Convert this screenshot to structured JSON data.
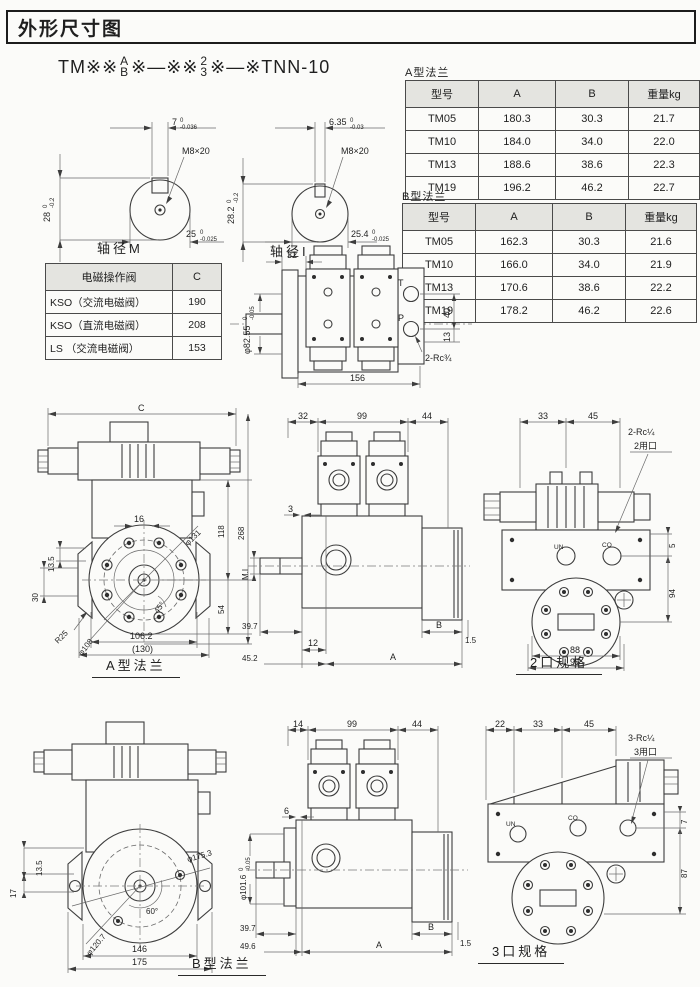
{
  "page": {
    "title": "外形尺寸图"
  },
  "model": {
    "prefix": "TM※※",
    "stack1_top": "A",
    "stack1_bottom": "B",
    "mid": "※—※※",
    "stack2_top": "2",
    "stack2_bottom": "3",
    "suffix": "※—※TNN-10"
  },
  "shaft_m": {
    "caption": "轴径M",
    "thread": "M8×20",
    "width": {
      "val": "7",
      "tol_top": "0",
      "tol_bot": "-0.036"
    },
    "height": {
      "val": "28",
      "tol_top": "0",
      "tol_bot": "-0.2"
    },
    "dia": {
      "val": "25",
      "tol_top": "0",
      "tol_bot": "-0.025"
    }
  },
  "shaft_i": {
    "caption": "轴径I",
    "thread": "M8×20",
    "width": {
      "val": "6.35",
      "tol_top": "0",
      "tol_bot": "-0.03"
    },
    "height": {
      "val": "28.2",
      "tol_top": "0",
      "tol_bot": "-0.2"
    },
    "dia": {
      "val": "25.4",
      "tol_top": "0",
      "tol_bot": "-0.025"
    }
  },
  "tables": {
    "flange_a": {
      "caption": "A型法兰",
      "headers": [
        "型号",
        "A",
        "B",
        "重量kg"
      ],
      "rows": [
        [
          "TM05",
          "180.3",
          "30.3",
          "21.7"
        ],
        [
          "TM10",
          "184.0",
          "34.0",
          "22.0"
        ],
        [
          "TM13",
          "188.6",
          "38.6",
          "22.3"
        ],
        [
          "TM19",
          "196.2",
          "46.2",
          "22.7"
        ]
      ]
    },
    "flange_b": {
      "caption": "B型法兰",
      "headers": [
        "型号",
        "A",
        "B",
        "重量kg"
      ],
      "rows": [
        [
          "TM05",
          "162.3",
          "30.3",
          "21.6"
        ],
        [
          "TM10",
          "166.0",
          "34.0",
          "21.9"
        ],
        [
          "TM13",
          "170.6",
          "38.6",
          "22.2"
        ],
        [
          "TM19",
          "178.2",
          "46.2",
          "22.6"
        ]
      ]
    },
    "solenoid": {
      "headers": [
        "电磁操作阀",
        "C"
      ],
      "rows": [
        [
          "KSO（交流电磁阀）",
          "190"
        ],
        [
          "KSO（直流电磁阀）",
          "208"
        ],
        [
          "LS （交流电磁阀）",
          "153"
        ]
      ]
    }
  },
  "views": {
    "top": {
      "dim_32": "32",
      "dia": {
        "val": "φ82.55",
        "tol_top": "0",
        "tol_bot": "-0.05"
      },
      "dim_156": "156",
      "dim_40": "40",
      "dim_13": "13",
      "port_t": "T",
      "port_p": "P",
      "ports_label": "2-Rc¾"
    },
    "flange_a": {
      "caption": "A型法兰",
      "dim_c": "C",
      "dim_16": "16",
      "dim_13_5": "13.5",
      "dim_30": "30",
      "r25": "R25",
      "dia_108": "φ108",
      "dia_131": "φ131",
      "angle_45": "45°",
      "dim_118": "118",
      "dim_268": "268",
      "dim_54": "54",
      "dim_106_2": "106.2",
      "dim_130": "(130)"
    },
    "side_a": {
      "dim_32": "32",
      "dim_99": "99",
      "dim_44": "44",
      "dim_3": "3",
      "shaft_label": "M.I",
      "dim_39_7": "39.7",
      "dim_12": "12",
      "dim_45_2": "45.2",
      "dim_a": "A",
      "dim_b": "B",
      "dim_1_5": "1.5"
    },
    "spec2": {
      "caption": "2口规格",
      "dim_33": "33",
      "dim_45": "45",
      "ports_label": "2-Rc¼",
      "ports_name": "2用口",
      "dim_5": "5",
      "dim_94": "94",
      "dim_88": "88",
      "dim_93": "93",
      "port_un": "UN",
      "port_co": "CO"
    },
    "flange_b": {
      "caption": "B型法兰",
      "dim_13_5": "13.5",
      "dim_17": "17",
      "dia_175_3": "φ175.3",
      "angle_60": "60°",
      "dia_120_7": "φ120.7",
      "dim_146": "146",
      "dim_175": "175"
    },
    "side_b": {
      "dim_14": "14",
      "dim_99": "99",
      "dim_44": "44",
      "dim_6": "6",
      "dia": {
        "val": "φ101.6",
        "tol_top": "0",
        "tol_bot": "-0.05"
      },
      "dim_39_7": "39.7",
      "dim_49_6": "49.6",
      "dim_a": "A",
      "dim_b": "B",
      "dim_1_5": "1.5"
    },
    "spec3": {
      "caption": "3口规格",
      "dim_22": "22",
      "dim_33": "33",
      "dim_45": "45",
      "ports_label": "3-Rc¼",
      "ports_name": "3用口",
      "dim_7": "7",
      "dim_87": "87",
      "port_un": "UN",
      "port_co": "CO"
    }
  }
}
